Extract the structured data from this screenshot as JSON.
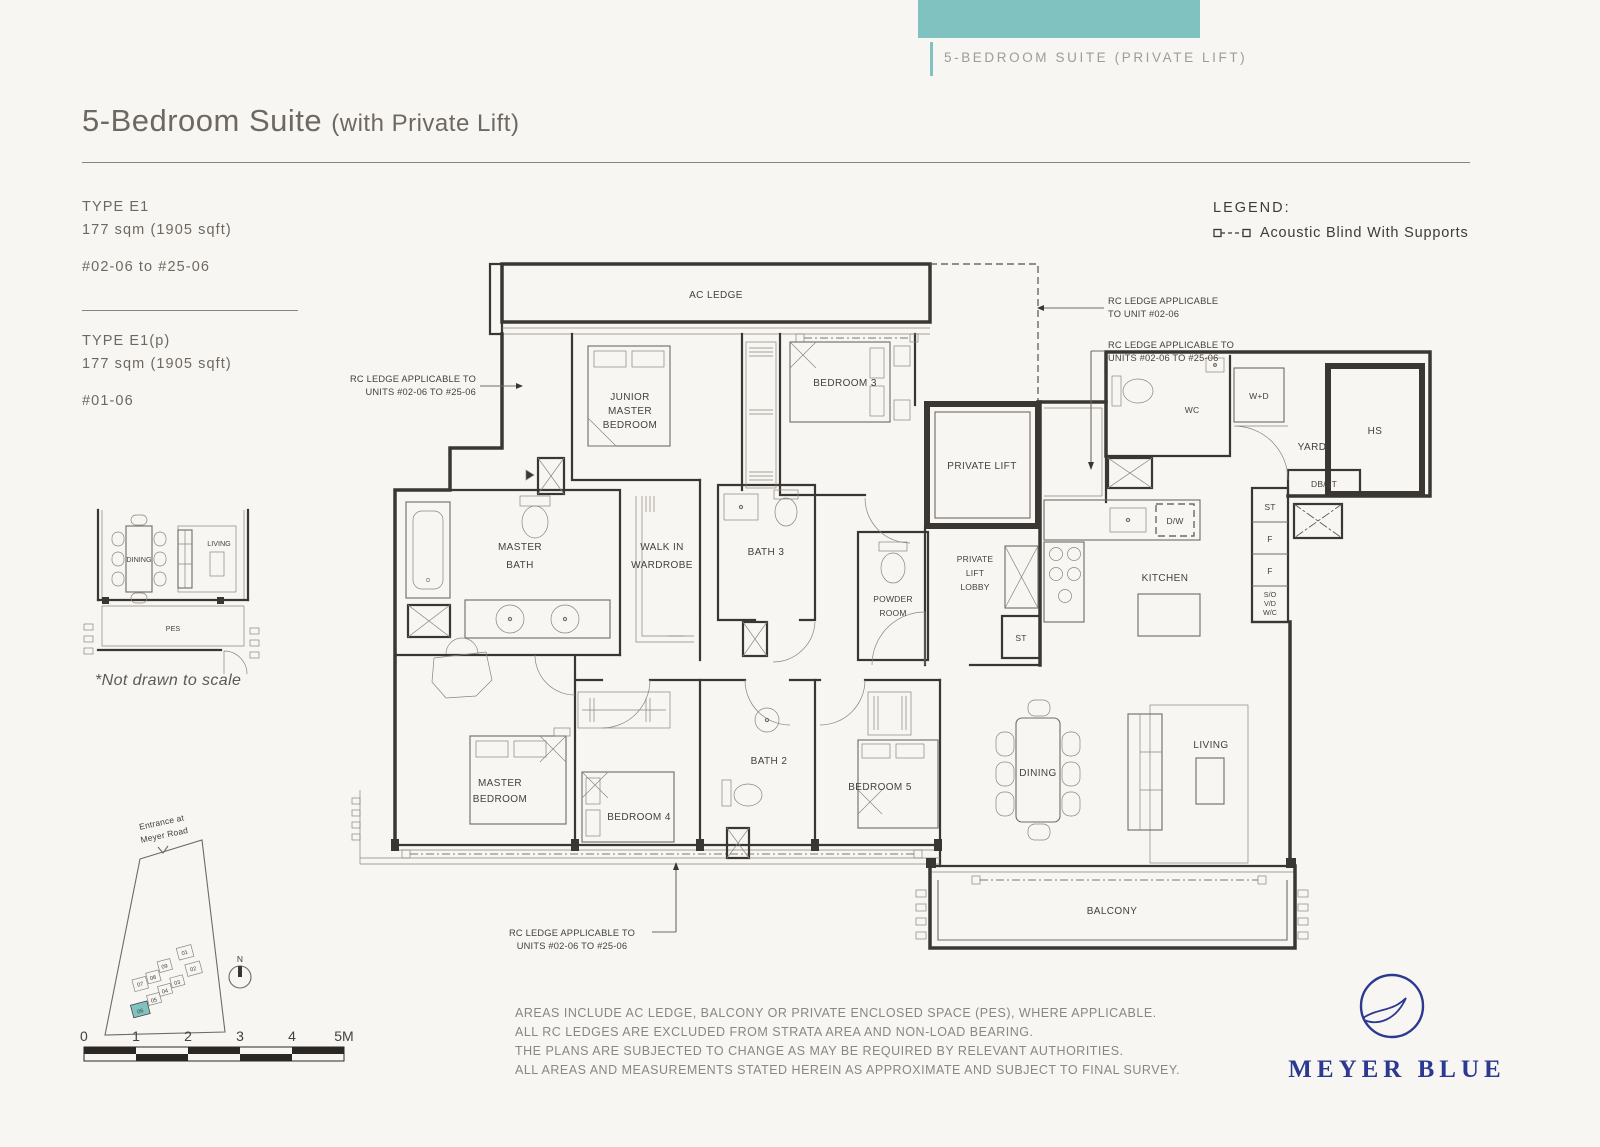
{
  "header": {
    "tab_label": "5-BEDROOM SUITE (PRIVATE LIFT)",
    "title": "5-Bedroom Suite",
    "title_suffix": "(with Private Lift)"
  },
  "unit_info": {
    "type1": {
      "type": "TYPE E1",
      "area": "177 sqm (1905 sqft)",
      "units": "#02-06 to #25-06"
    },
    "type2": {
      "type": "TYPE E1(p)",
      "area": "177 sqm (1905 sqft)",
      "units": "#01-06"
    },
    "scale_note": "*Not drawn to scale"
  },
  "legend": {
    "heading": "LEGEND:",
    "item": "Acoustic Blind With Supports"
  },
  "floor_plan": {
    "rooms": {
      "ac_ledge": "AC LEDGE",
      "junior_master": [
        "JUNIOR",
        "MASTER",
        "BEDROOM"
      ],
      "bedroom3": "BEDROOM 3",
      "private_lift": "PRIVATE LIFT",
      "wc": "WC",
      "wd": "W+D",
      "yard": "YARD",
      "hs": "HS",
      "db_st": "DB/ST",
      "master_bath": [
        "MASTER",
        "BATH"
      ],
      "walk_in": [
        "WALK IN",
        "WARDROBE"
      ],
      "bath3": "BATH 3",
      "powder": [
        "POWDER",
        "ROOM"
      ],
      "lift_lobby": [
        "PRIVATE",
        "LIFT",
        "LOBBY"
      ],
      "st_lobby": "ST",
      "dw": "D/W",
      "kitchen": "KITCHEN",
      "st_col": "ST",
      "f1": "F",
      "f2": "F",
      "so": [
        "S/O",
        "V/D",
        "W/C"
      ],
      "master_bedroom": [
        "MASTER",
        "BEDROOM"
      ],
      "bedroom4": "BEDROOM 4",
      "bath2": "BATH 2",
      "bedroom5": "BEDROOM 5",
      "dining": "DINING",
      "living": "LIVING",
      "balcony": "BALCONY"
    },
    "annotations": {
      "left": [
        "RC LEDGE APPLICABLE TO",
        "UNITS #02-06 TO #25-06"
      ],
      "top_right": [
        "RC LEDGE APPLICABLE",
        "TO UNIT #02-06"
      ],
      "right": [
        "RC LEDGE APPLICABLE TO",
        "UNITS #02-06 TO #25-06"
      ],
      "bottom": [
        "RC LEDGE APPLICABLE TO",
        "UNITS #02-06 TO #25-06"
      ]
    }
  },
  "thumbnail": {
    "living": "LIVING",
    "dining": "DINING",
    "pes": "PES"
  },
  "site_map": {
    "entrance_line1": "Entrance at",
    "entrance_line2": "Meyer Road",
    "north": "N",
    "units": [
      "01",
      "02",
      "03",
      "04",
      "05",
      "06",
      "07",
      "08",
      "09"
    ]
  },
  "scale_bar": {
    "labels": [
      "0",
      "1",
      "2",
      "3",
      "4",
      "5M"
    ]
  },
  "disclaimer": {
    "lines": [
      "AREAS INCLUDE AC LEDGE, BALCONY OR PRIVATE ENCLOSED SPACE (PES), WHERE APPLICABLE.",
      "ALL RC LEDGES ARE EXCLUDED FROM STRATA AREA AND NON-LOAD BEARING.",
      "THE PLANS ARE SUBJECTED TO CHANGE AS MAY BE REQUIRED BY RELEVANT AUTHORITIES.",
      "ALL AREAS AND MEASUREMENTS STATED HEREIN AS APPROXIMATE AND SUBJECT TO FINAL SURVEY."
    ]
  },
  "brand": {
    "name": "MEYER BLUE"
  },
  "colors": {
    "teal": "#7fc2bf",
    "navy": "#2b3990"
  }
}
